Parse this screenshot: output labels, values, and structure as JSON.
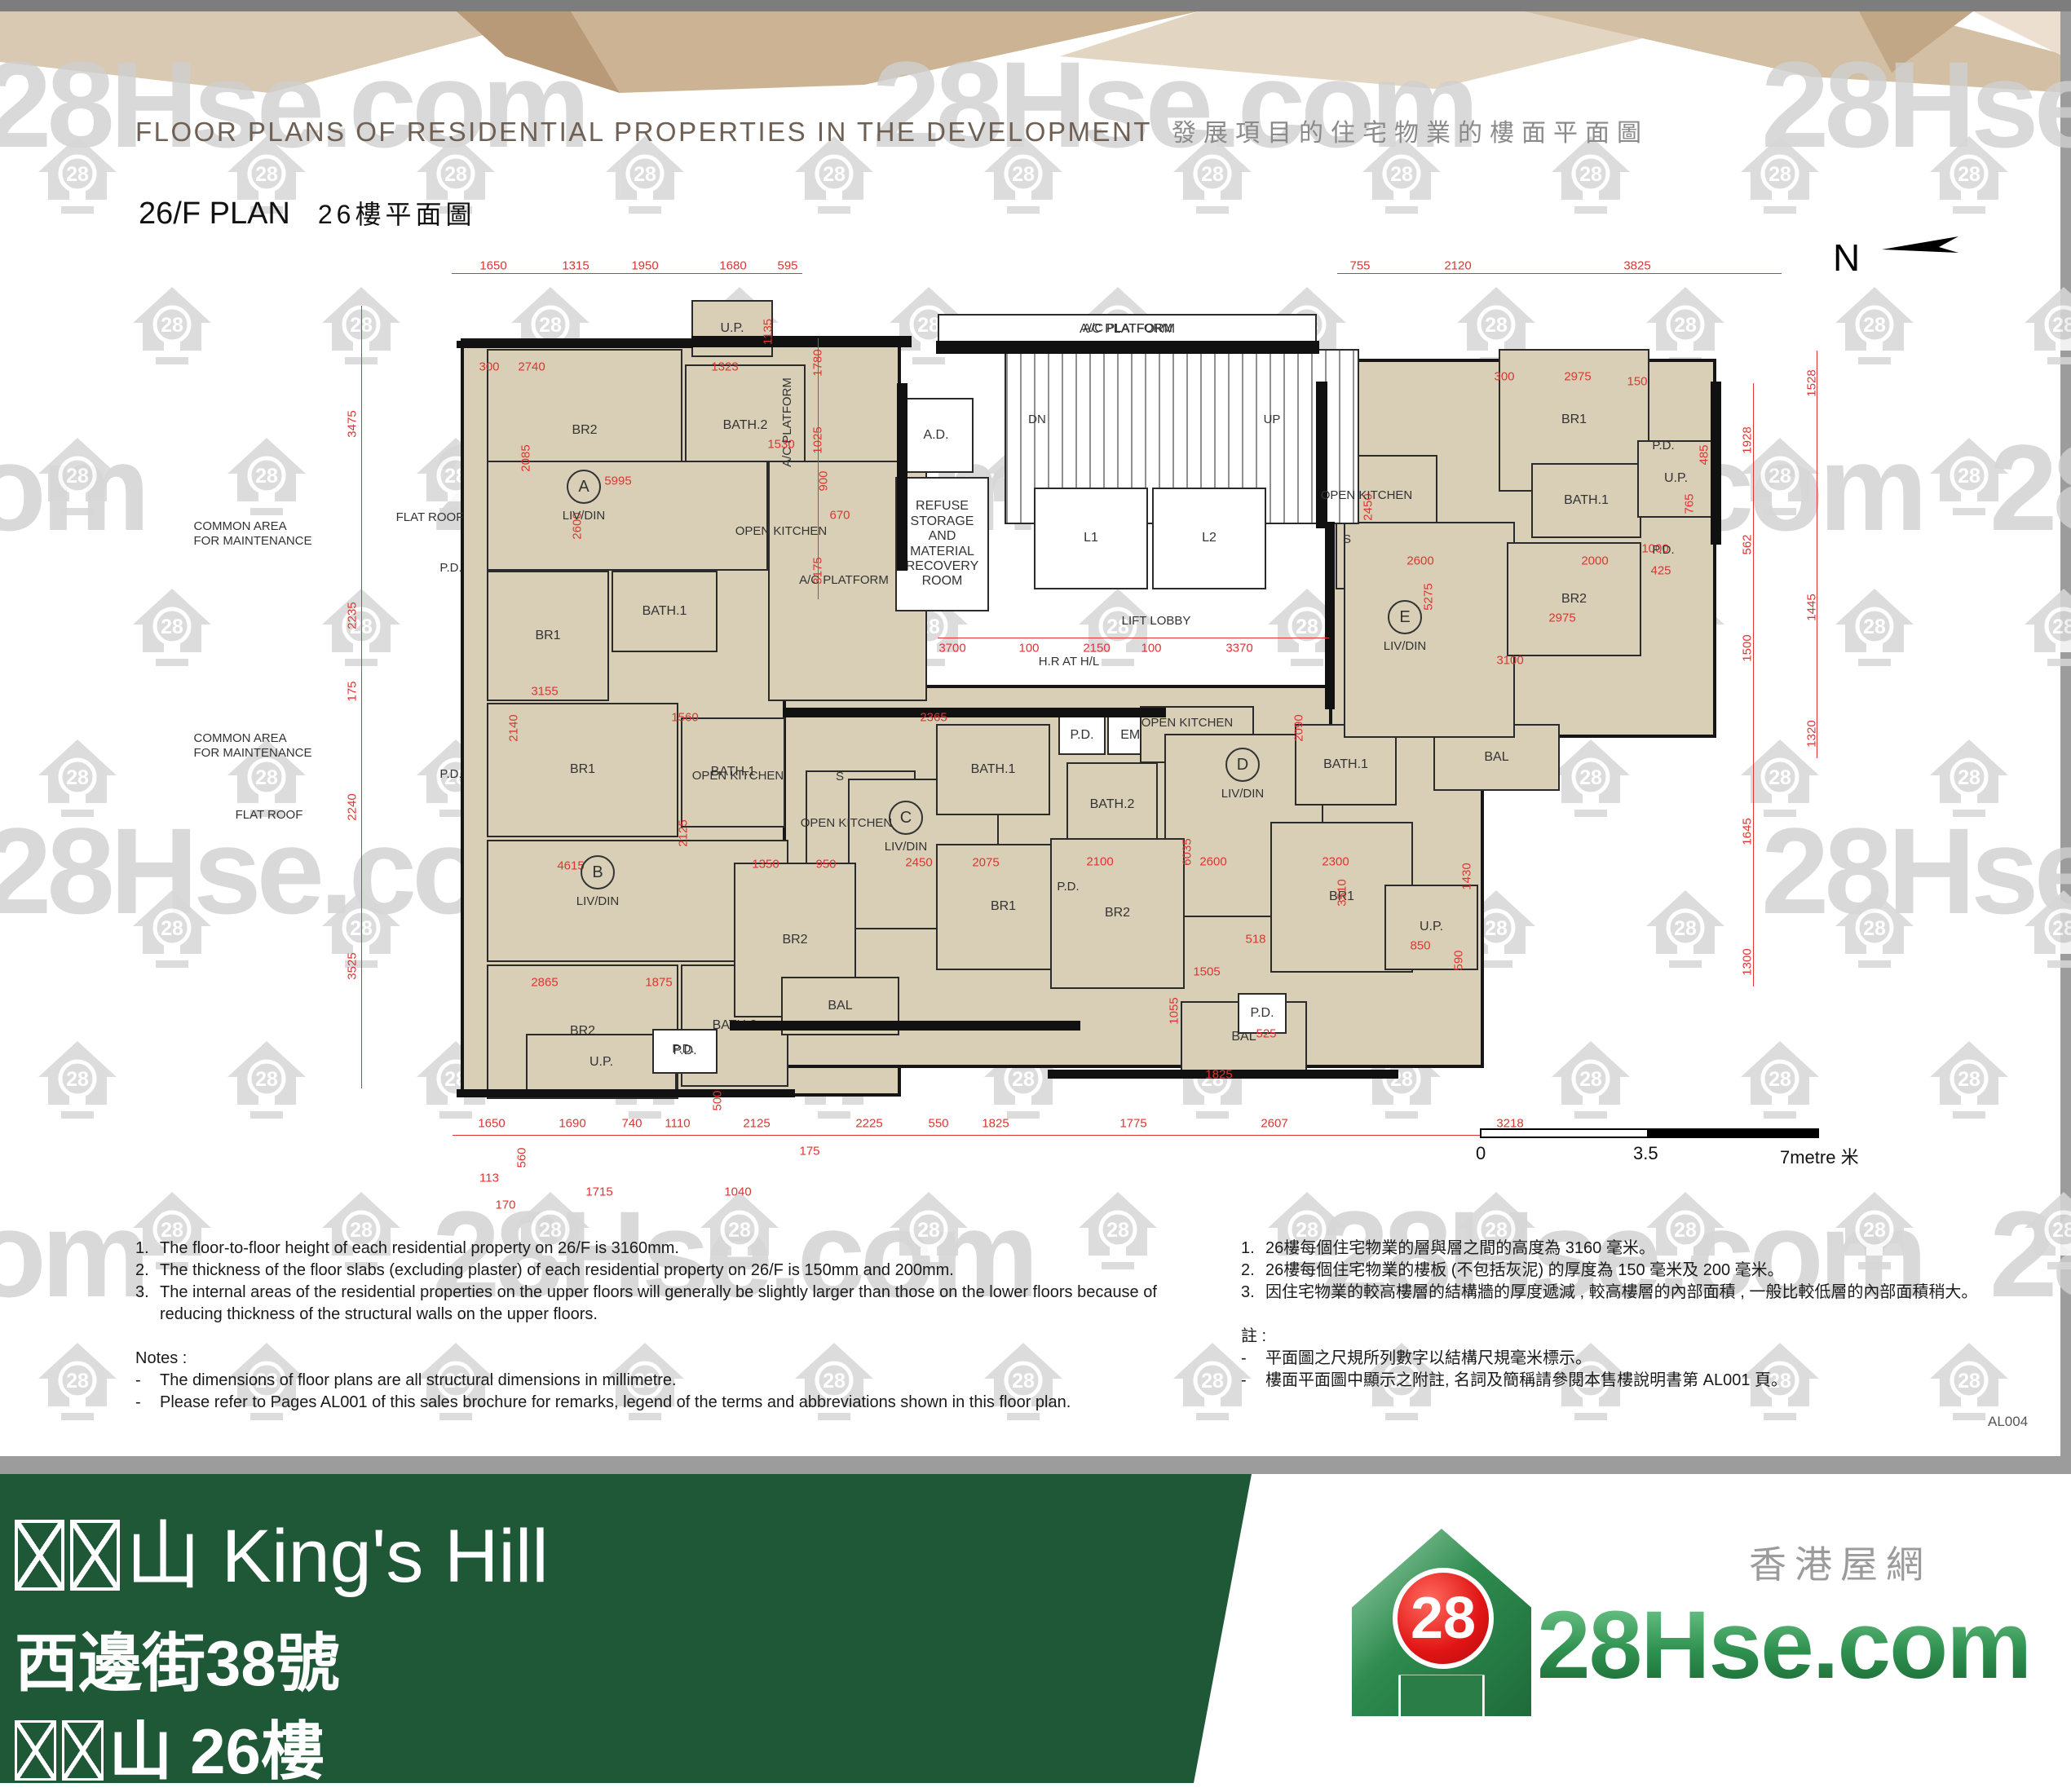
{
  "header": {
    "title_en": "FLOOR PLANS OF RESIDENTIAL PROPERTIES IN THE DEVELOPMENT",
    "title_zh": "發展項目的住宅物業的樓面平面圖",
    "plan_title_en": "26/F PLAN",
    "plan_title_zh": "26樓平面圖",
    "page_code": "AL004"
  },
  "watermark": {
    "text": "28Hse.com",
    "icon_text": "28"
  },
  "north": {
    "label": "N"
  },
  "scale_bar": {
    "start": "0",
    "mid": "3.5",
    "end": "7metre 米"
  },
  "notes_en": {
    "items": [
      "The floor-to-floor height of each residential property on 26/F is 3160mm.",
      "The thickness of the floor slabs (excluding plaster) of each residential property on 26/F is 150mm and 200mm.",
      "The internal areas of the residential properties on the upper floors will generally be slightly larger than those on the lower floors because of reducing thickness of the structural walls on the upper floors."
    ],
    "notes_label": "Notes :",
    "bullets": [
      "The dimensions of floor plans are all structural dimensions in millimetre.",
      "Please refer to Pages AL001 of this sales brochure for remarks, legend of the terms and abbreviations shown in this floor plan."
    ]
  },
  "notes_zh": {
    "items": [
      "26樓每個住宅物業的層與層之間的高度為 3160 毫米。",
      "26樓每個住宅物業的樓板 (不包括灰泥) 的厚度為 150 毫米及 200 毫米。",
      "因住宅物業的較高樓層的結構牆的厚度遞減 , 較高樓層的內部面積 , 一般比較低層的內部面積稍大。"
    ],
    "notes_label": "註 :",
    "bullets": [
      "平面圖之尺規所列數字以結構尺規毫米標示。",
      "樓面平面圖中顯示之附註, 名詞及簡稱請參閱本售樓說明書第 AL001 頁。"
    ]
  },
  "footer": {
    "line1_suffix": "山 King's Hill",
    "line2": "西邊街38號",
    "line3_suffix": "山 26樓"
  },
  "logo": {
    "brand": "28Hse.com",
    "tagline": "香港屋網",
    "badge": "28"
  },
  "plan": {
    "bases": [
      [
        565,
        415,
        540,
        930
      ],
      [
        960,
        840,
        860,
        470
      ],
      [
        1630,
        440,
        475,
        465
      ]
    ],
    "rooms": [
      [
        "BR2",
        597,
        428,
        240,
        200,
        "b"
      ],
      [
        "BATH.2",
        840,
        447,
        148,
        150,
        "b"
      ],
      [
        "",
        597,
        565,
        345,
        135,
        "b"
      ],
      [
        "BATH.1",
        750,
        700,
        130,
        100,
        "b"
      ],
      [
        "BR1",
        597,
        700,
        150,
        160,
        "b"
      ],
      [
        "",
        942,
        565,
        195,
        295,
        "b"
      ],
      [
        "U.P.",
        848,
        368,
        100,
        70,
        "b"
      ],
      [
        "BR1",
        597,
        862,
        235,
        165,
        "b"
      ],
      [
        "BATH.1",
        835,
        880,
        128,
        135,
        "b"
      ],
      [
        "",
        597,
        1030,
        370,
        150,
        "b"
      ],
      [
        "BR2",
        597,
        1183,
        235,
        165,
        "b"
      ],
      [
        "BATH.2",
        835,
        1183,
        132,
        150,
        "b"
      ],
      [
        "U.P.",
        645,
        1268,
        185,
        70,
        "b"
      ],
      [
        "P.D.",
        800,
        1262,
        80,
        55,
        "w"
      ],
      [
        "",
        988,
        945,
        135,
        125,
        "b"
      ],
      [
        "",
        1040,
        955,
        185,
        185,
        "b"
      ],
      [
        "BR2",
        900,
        1058,
        150,
        190,
        "b"
      ],
      [
        "BATH.1",
        1148,
        888,
        140,
        112,
        "b"
      ],
      [
        "BR1",
        1148,
        1035,
        165,
        155,
        "b"
      ],
      [
        "BAL",
        958,
        1198,
        145,
        72,
        "b"
      ],
      [
        "P.D.",
        1298,
        878,
        58,
        48,
        "w"
      ],
      [
        "EMD",
        1358,
        878,
        68,
        48,
        "w"
      ],
      [
        "BATH.2",
        1308,
        935,
        112,
        105,
        "b"
      ],
      [
        "",
        1398,
        866,
        140,
        70,
        "b"
      ],
      [
        "",
        1428,
        900,
        195,
        225,
        "b"
      ],
      [
        "BATH.1",
        1588,
        888,
        125,
        100,
        "b"
      ],
      [
        "BR2",
        1288,
        1028,
        165,
        185,
        "b"
      ],
      [
        "BR1",
        1558,
        1008,
        175,
        185,
        "b"
      ],
      [
        "BAL",
        1448,
        1228,
        155,
        88,
        "b"
      ],
      [
        "U.P.",
        1698,
        1085,
        115,
        105,
        "b"
      ],
      [
        "BAL",
        1758,
        888,
        155,
        82,
        "b"
      ],
      [
        "P.D.",
        1518,
        1218,
        60,
        50,
        "w"
      ],
      [
        "",
        1638,
        558,
        125,
        165,
        "b"
      ],
      [
        "",
        1648,
        640,
        210,
        265,
        "b"
      ],
      [
        "BR1",
        1838,
        428,
        185,
        175,
        "b"
      ],
      [
        "BATH.1",
        1878,
        568,
        135,
        92,
        "b"
      ],
      [
        "BR2",
        1848,
        665,
        165,
        140,
        "b"
      ],
      [
        "U.P.",
        2008,
        540,
        95,
        95,
        "b"
      ],
      [
        "A/C PLATFORM",
        1150,
        385,
        465,
        38,
        "w"
      ],
      [
        "",
        1232,
        428,
        435,
        215,
        "s"
      ],
      [
        "A.D.",
        1102,
        488,
        92,
        92,
        "w"
      ],
      [
        "REFUSE STORAGE\nAND MATERIAL\nRECOVERY ROOM",
        1098,
        585,
        115,
        165,
        "w"
      ],
      [
        "L1",
        1268,
        598,
        140,
        125,
        "w"
      ],
      [
        "L2",
        1413,
        598,
        140,
        125,
        "w"
      ]
    ],
    "walls": [
      [
        848,
        412,
        270,
        14
      ],
      [
        560,
        418,
        290,
        9
      ],
      [
        1148,
        418,
        470,
        16
      ],
      [
        1100,
        470,
        13,
        230
      ],
      [
        1614,
        468,
        14,
        180
      ],
      [
        960,
        868,
        470,
        12
      ],
      [
        895,
        1252,
        430,
        12
      ],
      [
        1285,
        1312,
        430,
        11
      ],
      [
        2098,
        468,
        13,
        200
      ],
      [
        560,
        1336,
        415,
        10
      ],
      [
        1625,
        640,
        12,
        230
      ]
    ],
    "dim_lines": [
      [
        554,
        335,
        430,
        "h"
      ],
      [
        1640,
        335,
        545,
        "h"
      ],
      [
        555,
        1392,
        1545,
        "h"
      ],
      [
        1150,
        782,
        480,
        "h"
      ],
      [
        443,
        375,
        960,
        "v"
      ],
      [
        2150,
        470,
        740,
        "v"
      ],
      [
        2228,
        430,
        500,
        "v"
      ],
      [
        1003,
        415,
        320,
        "v"
      ]
    ],
    "dims": [
      [
        "1650",
        605,
        326,
        0
      ],
      [
        "1315",
        706,
        326,
        0
      ],
      [
        "1950",
        791,
        326,
        0
      ],
      [
        "1680",
        899,
        326,
        0
      ],
      [
        "595",
        966,
        326,
        0
      ],
      [
        "755",
        1668,
        326,
        0
      ],
      [
        "2120",
        1788,
        326,
        0
      ],
      [
        "3825",
        2008,
        326,
        0
      ],
      [
        "1650",
        603,
        1378,
        0
      ],
      [
        "1690",
        702,
        1378,
        0
      ],
      [
        "740",
        775,
        1378,
        0
      ],
      [
        "1110",
        831,
        1378,
        0
      ],
      [
        "2125",
        928,
        1378,
        0
      ],
      [
        "175",
        993,
        1412,
        0
      ],
      [
        "2225",
        1066,
        1378,
        0
      ],
      [
        "550",
        1151,
        1378,
        0
      ],
      [
        "1825",
        1221,
        1378,
        0
      ],
      [
        "1775",
        1390,
        1378,
        0
      ],
      [
        "2607",
        1563,
        1378,
        0
      ],
      [
        "3218",
        1852,
        1378,
        0
      ],
      [
        "3475",
        432,
        520,
        1
      ],
      [
        "2235",
        432,
        755,
        1
      ],
      [
        "175",
        432,
        848,
        1
      ],
      [
        "2240",
        432,
        990,
        1
      ],
      [
        "3525",
        432,
        1185,
        1
      ],
      [
        "1928",
        2143,
        540,
        1
      ],
      [
        "562",
        2143,
        668,
        1
      ],
      [
        "1500",
        2143,
        795,
        1
      ],
      [
        "1645",
        2143,
        1020,
        1
      ],
      [
        "1300",
        2143,
        1180,
        1
      ],
      [
        "1528",
        2222,
        470,
        1
      ],
      [
        "1445",
        2222,
        745,
        1
      ],
      [
        "1320",
        2222,
        900,
        1
      ],
      [
        "3700",
        1168,
        795,
        0
      ],
      [
        "100",
        1262,
        795,
        0
      ],
      [
        "2150",
        1345,
        795,
        0
      ],
      [
        "100",
        1412,
        795,
        0
      ],
      [
        "3370",
        1520,
        795,
        0
      ],
      [
        "1323",
        889,
        450,
        0
      ],
      [
        "1135",
        942,
        407,
        1
      ],
      [
        "1780",
        1003,
        445,
        1
      ],
      [
        "1025",
        1003,
        540,
        1
      ],
      [
        "3175",
        1003,
        700,
        1
      ],
      [
        "2740",
        652,
        450,
        0
      ],
      [
        "300",
        600,
        450,
        0
      ],
      [
        "5995",
        758,
        590,
        0
      ],
      [
        "2600",
        708,
        645,
        1
      ],
      [
        "2085",
        645,
        562,
        1
      ],
      [
        "1530",
        958,
        545,
        0
      ],
      [
        "900",
        1010,
        590,
        1
      ],
      [
        "670",
        1030,
        632,
        0
      ],
      [
        "3155",
        668,
        848,
        0
      ],
      [
        "2140",
        630,
        893,
        1
      ],
      [
        "1560",
        840,
        880,
        0
      ],
      [
        "4615",
        700,
        1062,
        0
      ],
      [
        "2125",
        838,
        1022,
        1
      ],
      [
        "2865",
        668,
        1205,
        0
      ],
      [
        "1875",
        808,
        1205,
        0
      ],
      [
        "2365",
        1145,
        880,
        0
      ],
      [
        "2450",
        1127,
        1058,
        0
      ],
      [
        "2075",
        1209,
        1058,
        0
      ],
      [
        "1350",
        939,
        1060,
        0
      ],
      [
        "950",
        1013,
        1060,
        0
      ],
      [
        "2090",
        1593,
        893,
        1
      ],
      [
        "2100",
        1349,
        1057,
        0
      ],
      [
        "2600",
        1488,
        1057,
        0
      ],
      [
        "2300",
        1638,
        1057,
        0
      ],
      [
        "6035",
        1456,
        1045,
        1
      ],
      [
        "3510",
        1646,
        1095,
        1
      ],
      [
        "1825",
        1495,
        1318,
        0
      ],
      [
        "1505",
        1480,
        1192,
        0
      ],
      [
        "1055",
        1440,
        1240,
        1
      ],
      [
        "850",
        1742,
        1160,
        0
      ],
      [
        "1430",
        1799,
        1075,
        1
      ],
      [
        "590",
        1789,
        1178,
        1
      ],
      [
        "518",
        1540,
        1152,
        0
      ],
      [
        "525",
        1553,
        1268,
        0
      ],
      [
        "2975",
        1935,
        462,
        0
      ],
      [
        "300",
        1845,
        462,
        0
      ],
      [
        "150",
        2008,
        468,
        0
      ],
      [
        "5275",
        1752,
        732,
        1
      ],
      [
        "2600",
        1742,
        688,
        0
      ],
      [
        "2000",
        1956,
        688,
        0
      ],
      [
        "2450",
        1678,
        622,
        1
      ],
      [
        "2975",
        1916,
        758,
        0
      ],
      [
        "1000",
        2030,
        673,
        0
      ],
      [
        "425",
        2037,
        700,
        0
      ],
      [
        "3100",
        1852,
        810,
        0
      ],
      [
        "765",
        2072,
        618,
        1
      ],
      [
        "485",
        2090,
        558,
        1
      ],
      [
        "1715",
        735,
        1462,
        0
      ],
      [
        "1040",
        905,
        1462,
        0
      ],
      [
        "170",
        620,
        1478,
        0
      ],
      [
        "113",
        600,
        1445,
        0
      ],
      [
        "560",
        640,
        1420,
        1
      ],
      [
        "500",
        880,
        1350,
        1
      ]
    ],
    "labels": [
      [
        "COMMON AREA\nFOR MAINTENANCE",
        310,
        655,
        0
      ],
      [
        "COMMON AREA\nFOR MAINTENANCE",
        310,
        915,
        0
      ],
      [
        "FLAT ROOF",
        527,
        635,
        0
      ],
      [
        "FLAT ROOF",
        330,
        1000,
        0
      ],
      [
        "A/C PLATFORM",
        1383,
        403,
        0
      ],
      [
        "A/C PLATFORM",
        966,
        518,
        1
      ],
      [
        "A/C PLATFORM",
        1035,
        712,
        0
      ],
      [
        "OPEN KITCHEN",
        958,
        652,
        0
      ],
      [
        "OPEN KITCHEN",
        905,
        952,
        0
      ],
      [
        "OPEN KITCHEN",
        1038,
        1010,
        0
      ],
      [
        "OPEN KITCHEN",
        1456,
        887,
        0
      ],
      [
        "OPEN KITCHEN",
        1676,
        608,
        0
      ],
      [
        "LIFT LOBBY",
        1418,
        762,
        0
      ],
      [
        "H.R AT H/L",
        1311,
        812,
        0
      ],
      [
        "DN",
        1272,
        515,
        0
      ],
      [
        "UP",
        1560,
        515,
        0
      ],
      [
        "S",
        1030,
        953,
        0
      ],
      [
        "S",
        1652,
        662,
        0
      ],
      [
        "P.D.",
        553,
        697,
        0
      ],
      [
        "P.D.",
        553,
        950,
        0
      ],
      [
        "P.D.",
        838,
        1287,
        0
      ],
      [
        "P.D.",
        2040,
        547,
        0
      ],
      [
        "P.D.",
        2040,
        675,
        0
      ],
      [
        "P.D.",
        1310,
        1088,
        0
      ],
      [
        "LIV/DIN",
        716,
        633,
        0
      ],
      [
        "LIV/DIN",
        733,
        1106,
        0
      ],
      [
        "LIV/DIN",
        1111,
        1039,
        0
      ],
      [
        "LIV/DIN",
        1524,
        974,
        0
      ],
      [
        "LIV/DIN",
        1723,
        793,
        0
      ]
    ],
    "units": [
      [
        "A",
        716,
        597
      ],
      [
        "B",
        733,
        1070
      ],
      [
        "C",
        1111,
        1003
      ],
      [
        "D",
        1524,
        938
      ],
      [
        "E",
        1723,
        757
      ]
    ]
  }
}
